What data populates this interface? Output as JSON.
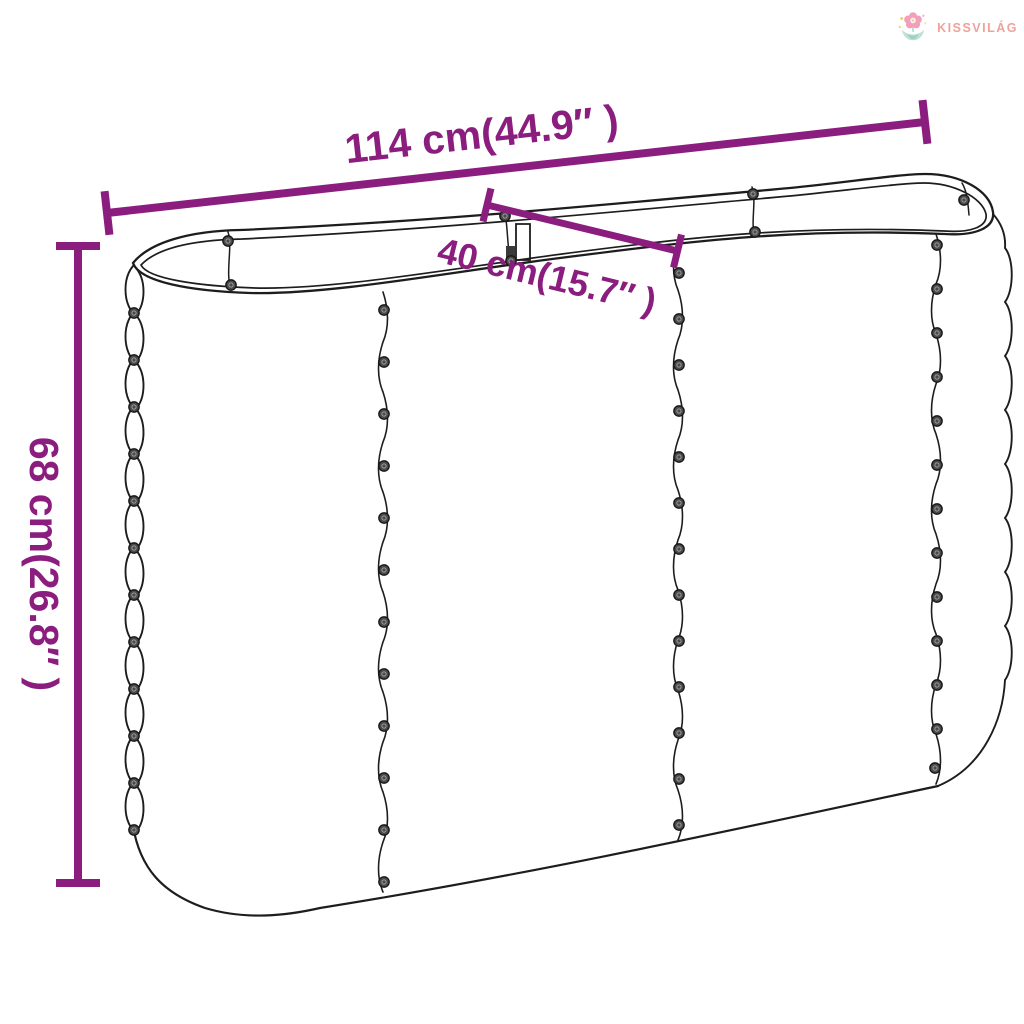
{
  "page": {
    "title": "Raised garden bed dimension diagram",
    "background": "#ffffff"
  },
  "logo": {
    "brand": "KISSVILÁG",
    "icon": "flower-logo-icon",
    "colors": {
      "text": "#f0a19a",
      "petal": "#f2a0b9",
      "petal_center": "#fdeef3",
      "leaf_light": "#bfe2d4",
      "leaf_dark": "#9fd2c0",
      "sparkle": "#f6cf6e"
    }
  },
  "diagram": {
    "type": "product-dimension-line-drawing",
    "subject": "oval corrugated steel raised garden bed planter",
    "colors": {
      "dimension_accent": "#8b1d7f",
      "line_art": "#1d1d1d"
    },
    "dimensions": [
      {
        "id": "length",
        "label": "114 cm(44.9″ )"
      },
      {
        "id": "width",
        "label": "40 cm(15.7″ )"
      },
      {
        "id": "height",
        "label": "68 cm(26.8″ )"
      }
    ]
  }
}
